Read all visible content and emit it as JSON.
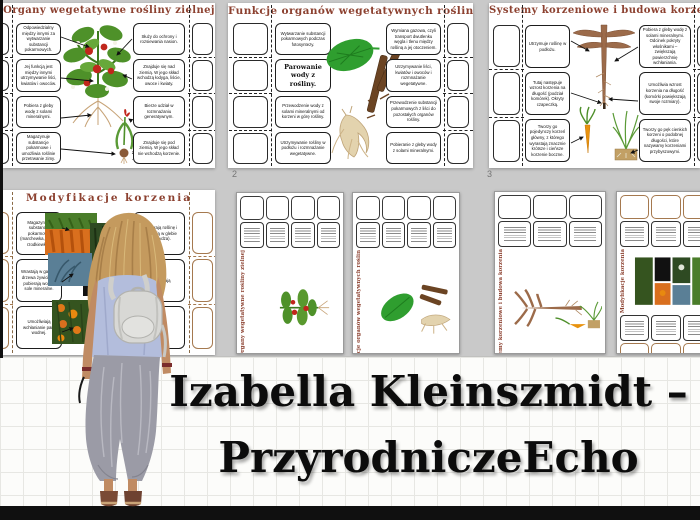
{
  "banner": {
    "line1": "Izabella Kleinszmidt –",
    "line2": "PrzyrodniczeEcho"
  },
  "colors": {
    "title_maroon": "#8c4130",
    "background_grey": "#c9c9c9",
    "banner_paper": "#fcfcfa",
    "black_bar": "#101010",
    "tan_border": "#a5794f"
  },
  "pages": {
    "p1": {
      "title": "Organy wegetatywne rośliny zielnej",
      "left_boxes": [
        "Odpowiedzialny między innymi za wytwarzanie substancji pokarmowych.",
        "Jej funkcją jest między innymi utrzymywanie liści, kwiatów i owoców.",
        "Pobiera z gleby wodę z solami mineralnymi.",
        "Magazynuje substancje pokarmowe i umożliwia roślinie przetrwanie zimy."
      ],
      "right_boxes": [
        "Służy do ochrony i rozsiewania nasion.",
        "Znajduje się nad ziemią. W jego skład wchodzą łodyga, liście, owoce i kwiaty.",
        "Bierze udział w rozmnażaniu generatywnym.",
        "Znajduje się pod ziemią. W jego skład nie wchodzą korzenie."
      ]
    },
    "p2": {
      "title": "Funkcje organów wegetatywnych roślin",
      "page_number": "2",
      "left_boxes": [
        "Wytwarzanie substancji pokarmowych podczas fotosyntezy.",
        "Parowanie wody z rośliny.",
        "Przewodzenie wody z solami mineralnymi od korzeni w górę rośliny.",
        "Utrzymywanie rośliny w podłożu i rozmnażanie wegetatywne."
      ],
      "right_boxes": [
        "Wymiana gazowa, czyli transport dwutlenku węgla i tlenu między rośliną a jej otoczeniem.",
        "Utrzymywanie liści, kwiatów i owoców i rozmnażanie wegetatywne.",
        "Przewodzenie substancji pokarmowych z liści do pozostałych organów rośliny.",
        "Pobieranie z gleby wody z solami mineralnymi."
      ]
    },
    "p3": {
      "title": "Systemy korzeniowe i budowa korzenia",
      "page_number": "3",
      "left_boxes": [
        "Utrzymuje roślinę w podłożu.",
        "Tutaj następuje wzrost korzenia na długość (podział komórek). Okryty czapeczką.",
        "Tworzy go pojedynczy korzeń główny, z którego wyrastają znacznie krótsze i cieńsze korzenie boczne."
      ],
      "right_boxes": [
        "Pobiera z gleby wodę z solami mineralnymi. Odcinek pokryty włośnikami – zwiększają powierzchnię wchłaniania.",
        "Umożliwia wzrost korzenia na długość (komórki powiększają swoje rozmiary).",
        "Tworzy go pęk cienkich korzeni o podobnej długości, które nazywamy korzeniami przybyszowymi."
      ]
    },
    "p4": {
      "title": "Modyfikacje korzenia",
      "left_boxes": [
        "Magazynują substancje pokarmowe (marchewka, burak, rzodkiewka).",
        "Wrastają w gałęzie drzewa żywiciela i pobierają wodę i sole mineralne.",
        "Umożliwiają wchłanianie pary wodnej."
      ],
      "right_boxes": [
        "Podpierają roślinę i stabilizują w glebie (kukurydza).",
        "Umożliwiają",
        ""
      ]
    },
    "p5": {
      "title": "Organy wegetatywne rośliny zielnej"
    },
    "p6": {
      "title": "Funkcje organów wegetatywnych roślin"
    },
    "p7": {
      "title": "Systemy korzeniowe i budowa korzenia"
    },
    "p8": {
      "title": "Modyfikacje korzenia"
    }
  }
}
